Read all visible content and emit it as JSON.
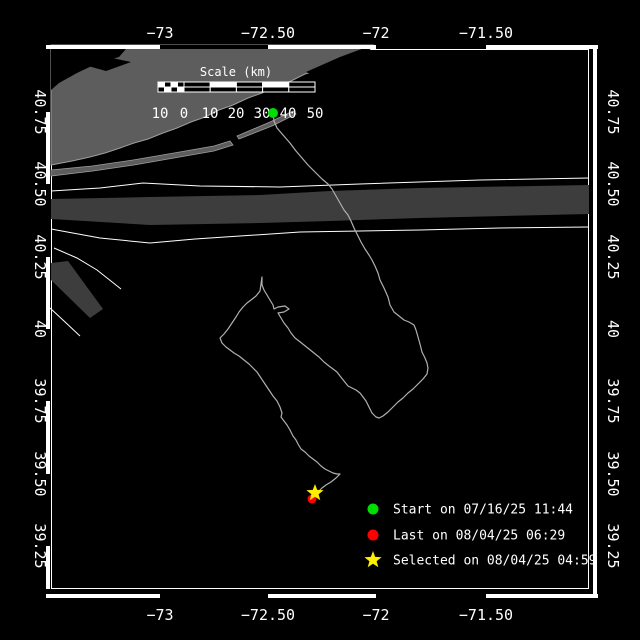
{
  "colors": {
    "background": "#000000",
    "land": "#5d5d5d",
    "lane": "#3d3d3d",
    "white_line": "#ffffff",
    "coast": "#9d9d9d",
    "track": "#b0b0b0",
    "start": "#00dd00",
    "last": "#ff0000",
    "selected": "#ffee00",
    "frame": "#ffffff",
    "text": "#ffffff"
  },
  "axes": {
    "lon_labels": [
      {
        "text": "−73",
        "x": 160
      },
      {
        "text": "−72.50",
        "x": 268
      },
      {
        "text": "−72",
        "x": 376
      },
      {
        "text": "−71.50",
        "x": 486
      }
    ],
    "lat_labels": [
      {
        "text": "40.75",
        "y": 112
      },
      {
        "text": "40.50",
        "y": 184
      },
      {
        "text": "40.25",
        "y": 257
      },
      {
        "text": "40",
        "y": 329
      },
      {
        "text": "39.75",
        "y": 401
      },
      {
        "text": "39.50",
        "y": 474
      },
      {
        "text": "39.25",
        "y": 546
      }
    ],
    "top_label_baseline": 38,
    "bottom_label_baseline": 620,
    "left_label_x": 35,
    "right_label_x": 608
  },
  "frame": {
    "x0": 51,
    "y0": 49,
    "x1": 589,
    "y1": 589,
    "band": {
      "top_y": 45,
      "bottom_y": 594,
      "left_x": 46,
      "right_x": 593,
      "thickness": 4,
      "outer_x0": 46,
      "outer_x1": 598,
      "outer_y1": 598
    }
  },
  "scalebar": {
    "title": "Scale (km)",
    "title_x": 236,
    "title_y": 76,
    "bar_x0": 158,
    "bar_zero": 184,
    "cell_w": 26.2,
    "fine_cells": 4,
    "main_cells": 5,
    "bar_y": 82,
    "row_h": 5,
    "labels": [
      {
        "text": "10",
        "x": 160
      },
      {
        "text": "0",
        "x": 184
      },
      {
        "text": "10",
        "x": 210
      },
      {
        "text": "20",
        "x": 236
      },
      {
        "text": "30",
        "x": 262
      },
      {
        "text": "40",
        "x": 288
      },
      {
        "text": "50",
        "x": 315
      }
    ],
    "label_baseline": 118
  },
  "legend": {
    "marker_x": 373,
    "text_x": 393,
    "items": [
      {
        "marker": "circle",
        "color": "#00dd00",
        "label": "Start on 07/16/25 11:44",
        "y": 509
      },
      {
        "marker": "circle",
        "color": "#ff0000",
        "label": "Last on 08/04/25 06:29",
        "y": 535
      },
      {
        "marker": "star",
        "color": "#ffee00",
        "label": "Selected on 08/04/25 04:59",
        "y": 560
      }
    ]
  },
  "map": {
    "mainland": [
      [
        51,
        165
      ],
      [
        51,
        45
      ],
      [
        374,
        45
      ],
      [
        361,
        51
      ],
      [
        348,
        59
      ],
      [
        334,
        63
      ],
      [
        319,
        70
      ],
      [
        305,
        74
      ],
      [
        291,
        81
      ],
      [
        276,
        86
      ],
      [
        262,
        93
      ],
      [
        248,
        98
      ],
      [
        233,
        105
      ],
      [
        219,
        110
      ],
      [
        205,
        117
      ],
      [
        191,
        122
      ],
      [
        177,
        128
      ],
      [
        163,
        133
      ],
      [
        148,
        139
      ],
      [
        134,
        143
      ],
      [
        120,
        148
      ],
      [
        105,
        153
      ],
      [
        90,
        157
      ],
      [
        72,
        161
      ],
      [
        51,
        165
      ]
    ],
    "cutouts": [
      [
        [
          51,
          49
        ],
        [
          126,
          49
        ],
        [
          119,
          57
        ],
        [
          98,
          63
        ],
        [
          77,
          73
        ],
        [
          59,
          83
        ],
        [
          51,
          90
        ]
      ],
      [
        [
          88,
          66
        ],
        [
          112,
          58
        ],
        [
          131,
          62
        ],
        [
          106,
          71
        ]
      ],
      [
        [
          306,
          72
        ],
        [
          340,
          57
        ],
        [
          367,
          47
        ],
        [
          372,
          51
        ],
        [
          345,
          62
        ],
        [
          317,
          77
        ]
      ]
    ],
    "barriers": [
      [
        [
          51,
          170
        ],
        [
          92,
          166
        ],
        [
          133,
          160
        ],
        [
          174,
          153
        ],
        [
          214,
          146
        ],
        [
          230,
          141
        ],
        [
          233,
          145
        ],
        [
          214,
          151
        ],
        [
          174,
          158
        ],
        [
          134,
          165
        ],
        [
          93,
          171
        ],
        [
          51,
          176
        ]
      ],
      [
        [
          237,
          136
        ],
        [
          270,
          122
        ],
        [
          293,
          111
        ],
        [
          296,
          114
        ],
        [
          272,
          126
        ],
        [
          239,
          139
        ]
      ]
    ],
    "lanes": {
      "upper_line": [
        [
          51,
          191
        ],
        [
          100,
          188
        ],
        [
          143,
          183
        ],
        [
          200,
          186
        ],
        [
          280,
          187
        ],
        [
          360,
          184
        ],
        [
          480,
          180
        ],
        [
          589,
          178
        ]
      ],
      "band": [
        [
          51,
          199
        ],
        [
          150,
          197
        ],
        [
          260,
          195
        ],
        [
          330,
          191
        ],
        [
          420,
          188
        ],
        [
          589,
          185
        ],
        [
          589,
          214
        ],
        [
          420,
          218
        ],
        [
          330,
          221
        ],
        [
          260,
          223
        ],
        [
          150,
          225
        ],
        [
          51,
          219
        ]
      ],
      "lower_line": [
        [
          51,
          229
        ],
        [
          100,
          238
        ],
        [
          150,
          243
        ],
        [
          195,
          239
        ],
        [
          240,
          236
        ],
        [
          300,
          232
        ],
        [
          360,
          231
        ],
        [
          420,
          230
        ],
        [
          500,
          228
        ],
        [
          589,
          227
        ]
      ],
      "diag_line_a": [
        [
          54,
          248
        ],
        [
          77,
          258
        ],
        [
          97,
          270
        ],
        [
          121,
          289
        ]
      ],
      "diag_band": [
        [
          51,
          263
        ],
        [
          68,
          261
        ],
        [
          103,
          309
        ],
        [
          90,
          318
        ],
        [
          51,
          280
        ]
      ],
      "diag_line_b": [
        [
          50,
          308
        ],
        [
          64,
          321
        ],
        [
          80,
          336
        ]
      ]
    },
    "track": [
      [
        273,
        113
      ],
      [
        274,
        121
      ],
      [
        277,
        128
      ],
      [
        283,
        135
      ],
      [
        290,
        143
      ],
      [
        296,
        151
      ],
      [
        302,
        158
      ],
      [
        308,
        165
      ],
      [
        315,
        172
      ],
      [
        322,
        179
      ],
      [
        328,
        184
      ],
      [
        332,
        189
      ],
      [
        336,
        196
      ],
      [
        340,
        203
      ],
      [
        344,
        210
      ],
      [
        348,
        215
      ],
      [
        351,
        221
      ],
      [
        354,
        228
      ],
      [
        357,
        234
      ],
      [
        361,
        242
      ],
      [
        365,
        249
      ],
      [
        369,
        255
      ],
      [
        372,
        260
      ],
      [
        375,
        266
      ],
      [
        378,
        273
      ],
      [
        380,
        280
      ],
      [
        384,
        288
      ],
      [
        388,
        297
      ],
      [
        390,
        305
      ],
      [
        394,
        312
      ],
      [
        399,
        316
      ],
      [
        404,
        320
      ],
      [
        409,
        322
      ],
      [
        414,
        325
      ],
      [
        416,
        330
      ],
      [
        418,
        337
      ],
      [
        420,
        344
      ],
      [
        422,
        352
      ],
      [
        425,
        358
      ],
      [
        427,
        363
      ],
      [
        428,
        368
      ],
      [
        427,
        374
      ],
      [
        423,
        379
      ],
      [
        418,
        384
      ],
      [
        413,
        389
      ],
      [
        408,
        393
      ],
      [
        403,
        398
      ],
      [
        398,
        402
      ],
      [
        393,
        407
      ],
      [
        388,
        412
      ],
      [
        383,
        416
      ],
      [
        379,
        418
      ],
      [
        376,
        417
      ],
      [
        372,
        413
      ],
      [
        369,
        407
      ],
      [
        366,
        401
      ],
      [
        363,
        397
      ],
      [
        360,
        393
      ],
      [
        356,
        390
      ],
      [
        352,
        388
      ],
      [
        348,
        386
      ],
      [
        344,
        381
      ],
      [
        340,
        376
      ],
      [
        337,
        372
      ],
      [
        333,
        369
      ],
      [
        329,
        366
      ],
      [
        324,
        362
      ],
      [
        319,
        357
      ],
      [
        314,
        353
      ],
      [
        309,
        349
      ],
      [
        304,
        345
      ],
      [
        299,
        341
      ],
      [
        295,
        338
      ],
      [
        291,
        333
      ],
      [
        288,
        328
      ],
      [
        284,
        323
      ],
      [
        281,
        318
      ],
      [
        278,
        313
      ],
      [
        284,
        312
      ],
      [
        289,
        309
      ],
      [
        285,
        306
      ],
      [
        278,
        307
      ],
      [
        274,
        309
      ],
      [
        273,
        305
      ],
      [
        270,
        300
      ],
      [
        267,
        295
      ],
      [
        264,
        290
      ],
      [
        262,
        285
      ],
      [
        262,
        277
      ],
      [
        261,
        284
      ],
      [
        260,
        291
      ],
      [
        256,
        296
      ],
      [
        251,
        300
      ],
      [
        247,
        303
      ],
      [
        243,
        307
      ],
      [
        239,
        312
      ],
      [
        236,
        317
      ],
      [
        232,
        323
      ],
      [
        228,
        329
      ],
      [
        224,
        334
      ],
      [
        220,
        338
      ],
      [
        222,
        343
      ],
      [
        226,
        347
      ],
      [
        230,
        350
      ],
      [
        234,
        353
      ],
      [
        239,
        356
      ],
      [
        244,
        360
      ],
      [
        249,
        364
      ],
      [
        253,
        368
      ],
      [
        257,
        372
      ],
      [
        261,
        378
      ],
      [
        265,
        384
      ],
      [
        269,
        390
      ],
      [
        273,
        396
      ],
      [
        277,
        401
      ],
      [
        280,
        407
      ],
      [
        282,
        413
      ],
      [
        281,
        417
      ],
      [
        284,
        421
      ],
      [
        287,
        425
      ],
      [
        290,
        430
      ],
      [
        293,
        436
      ],
      [
        296,
        440
      ],
      [
        298,
        444
      ],
      [
        301,
        449
      ],
      [
        305,
        452
      ],
      [
        309,
        456
      ],
      [
        313,
        459
      ],
      [
        317,
        462
      ],
      [
        321,
        466
      ],
      [
        325,
        469
      ],
      [
        329,
        471
      ],
      [
        333,
        473
      ],
      [
        337,
        474
      ],
      [
        340,
        474
      ],
      [
        336,
        478
      ],
      [
        331,
        482
      ],
      [
        326,
        485
      ],
      [
        322,
        488
      ],
      [
        319,
        491
      ],
      [
        316,
        493
      ]
    ],
    "markers": {
      "start": {
        "x": 273,
        "y": 113,
        "r": 5
      },
      "last": {
        "x": 312,
        "y": 499,
        "r": 4.5
      },
      "selected": {
        "x": 315,
        "y": 493,
        "r": 9
      }
    }
  }
}
